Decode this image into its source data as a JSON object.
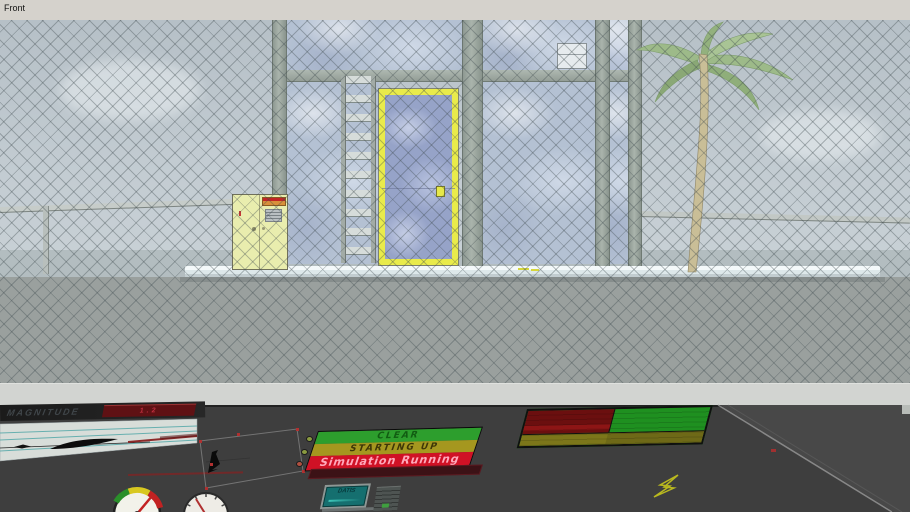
{
  "window": {
    "view_label": "Front"
  },
  "scene": {
    "fence_color": "#3e4a4e",
    "sky_color": "#bcc6cc",
    "sea_color": "#b3bdc0",
    "ground_color": "#9aa09e",
    "door": {
      "frame_color": "#e9eb4b",
      "glass_color": "#96a3c8"
    },
    "cabinet": {
      "body_color": "#e9edae"
    },
    "palm_tree": {
      "trunk_color": "#c9be97",
      "leaf_color": "#9dba89"
    },
    "platform_color": "#f2f7f8"
  },
  "console": {
    "magnitude": {
      "label": "MAGNITUDE",
      "badge": "1.2",
      "badge_color": "#5f1114"
    },
    "status_sign": {
      "rows": [
        {
          "label": "CLEAR",
          "bg": "#2d9e2d",
          "fg": "#115c12"
        },
        {
          "label": "STARTING UP",
          "bg": "#a5971f",
          "fg": "#3d3608"
        },
        {
          "label": "Simulation Running",
          "bg": "#d01125",
          "fg": "#ffa9bb"
        }
      ]
    },
    "datis": {
      "label": "DATIS"
    },
    "status_board": {
      "alarm_color": "#6b0f0f",
      "ok_color": "#1f9020",
      "caution_color": "#7c761a"
    },
    "desk_color": "#3e3e3e"
  }
}
